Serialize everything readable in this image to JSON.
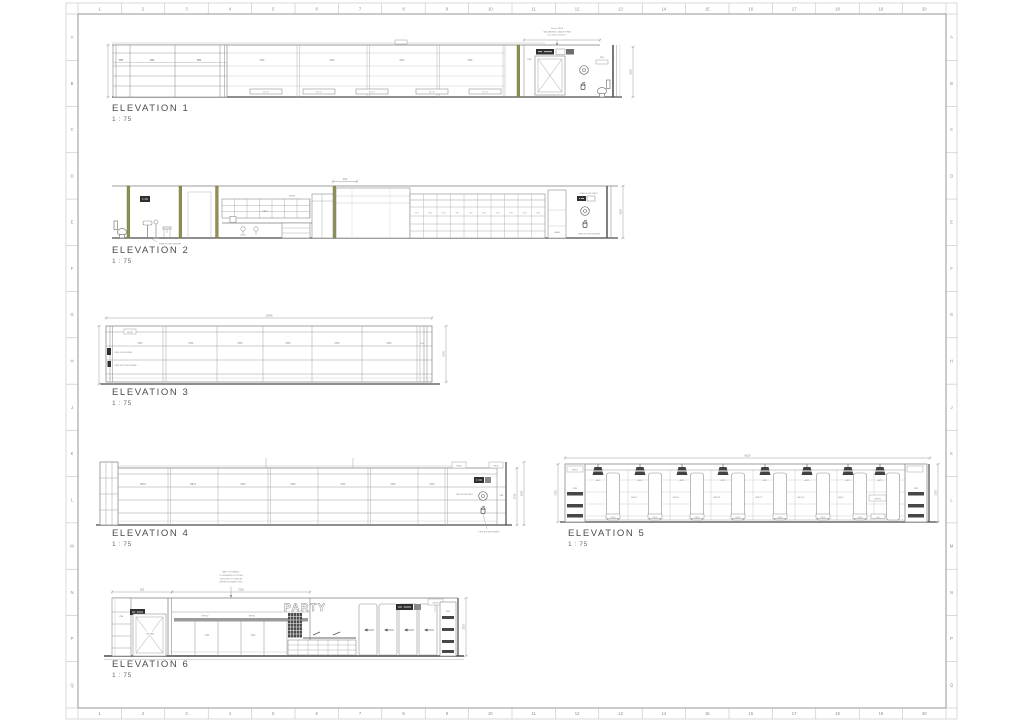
{
  "colors": {
    "line": "#8a8a8a",
    "dark": "#474747",
    "sign": "#2f2f2f",
    "olive": "#8f9052",
    "dim": "#9a9a9a",
    "text": "#6e6e6e"
  },
  "sheet": {
    "columns": [
      "1",
      "2",
      "3",
      "4",
      "5",
      "6",
      "7",
      "8",
      "9",
      "10",
      "11",
      "12",
      "13",
      "14",
      "15",
      "16",
      "17",
      "18",
      "19",
      "20"
    ],
    "rows": [
      "A",
      "B",
      "C",
      "D",
      "E",
      "F",
      "G",
      "H",
      "J",
      "K",
      "L",
      "M",
      "N",
      "P",
      "Q"
    ]
  },
  "elevations": {
    "e1": {
      "title": "ELEVATION 1",
      "scale": "1 : 75",
      "bays": [
        "PB6",
        "PB6",
        "PB2",
        "PB6",
        "PB6",
        "PB6",
        "PB6"
      ],
      "floor_boxes": [
        "BCO2",
        "BCO2",
        "BCO2",
        "BCO2",
        "BCO2"
      ],
      "right_labels": [
        "PB2",
        "PB1"
      ],
      "note": [
        "50mm WIDE",
        "GALVANISED CABLE TRAY",
        "@ 2700mm A.F.F.L."
      ],
      "dims": {
        "right": "3000"
      }
    },
    "e2": {
      "title": "ELEVATION 2",
      "scale": "1 : 75",
      "labels": [
        "CPK14",
        "PB12",
        "GB03"
      ],
      "shelf_label": "GB1",
      "fire_hose": "FIRE HOSE REEL",
      "fire_ext": "FIRE EXTINGUISHER",
      "fire_ext_left": "FIRE EXTINGUISHER",
      "dims": {
        "top": "600",
        "right": "3000"
      }
    },
    "e3": {
      "title": "ELEVATION 3",
      "scale": "1 : 75",
      "gpo": "GPO21",
      "bays": [
        "PB2",
        "PB6",
        "PB6",
        "PB6",
        "PB6",
        "PB6",
        "PB6"
      ],
      "fire_hose": "FIRE HOSE REEL",
      "fire_ext": "FIRE EXTINGUISHER",
      "dims": {
        "top": "11890",
        "right": "2400"
      }
    },
    "e4": {
      "title": "ELEVATION 4",
      "scale": "1 : 75",
      "bays": [
        "PB13",
        "PB13",
        "PB6",
        "PB6",
        "PB6",
        "PB6",
        "PB6"
      ],
      "gpo2": "GPO2",
      "gpo1": "GPO1",
      "pb1": "PB1",
      "fire_hose": "FIRE HOSE REEL",
      "fire_ext": "FIRE EXTINGUISHER",
      "dims": {
        "right1": "2700",
        "right2": "3000"
      }
    },
    "e5": {
      "title": "ELEVATION 5",
      "scale": "1 : 75",
      "spgo": "SPGO",
      "pb_left": "PB1",
      "pb_right": "PB1",
      "gpop": "GPOP2",
      "pendant_labels": [
        "ASD",
        "ASD2",
        "ASP1",
        "ASP2",
        "ASD",
        "ASPG",
        "ASP1",
        "ASP3"
      ],
      "bay_labels": [
        "ASP3",
        "ASPO",
        "ASPP1",
        "ASPT2",
        "ASPG2",
        "ASP2"
      ],
      "floor_boxes": [
        "EB03",
        "EB03",
        "EB03",
        "EB03",
        "EB03",
        "EB03",
        "EB03",
        "EB2"
      ],
      "dims": {
        "top": "8525",
        "left": "2700",
        "right": "2700"
      }
    },
    "e6": {
      "title": "ELEVATION 6",
      "scale": "1 : 75",
      "pb_left": "PB1",
      "door_label": "CPL GRD",
      "gpo30": "GPO30",
      "gpo11": "GPO11",
      "gs4": [
        "GS4",
        "GS4"
      ],
      "party": "PARTY",
      "gpo12": "GPO12",
      "pb_right": "PB1",
      "note": [
        "PARTY SIGNAGE -",
        "ILLUMINATED LETTERS",
        "MOUNTED TO FASCIA",
        "REFER SIGNAGE DWG"
      ],
      "dims": {
        "a": "650",
        "b": "2365",
        "right": "3000"
      }
    }
  }
}
